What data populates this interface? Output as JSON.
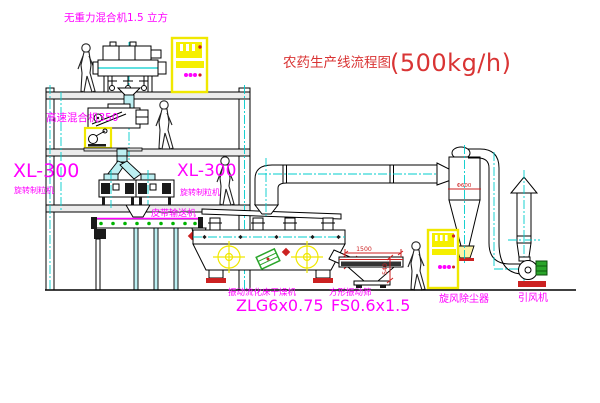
{
  "title": {
    "prefix": "农药生产线流程图",
    "capacity": "(500kg/h)"
  },
  "labels": {
    "gravity_mixer": "无重力混合机1.5 立方",
    "high_speed_mixer": "高速混合机350",
    "granulator_model_left": "XL-300",
    "granulator_name_left": "旋转制粒机",
    "granulator_model_right": "XL-300",
    "granulator_name_right": "旋转制粒机",
    "belt_conveyor": "皮带输送机",
    "dryer_name": "振动流化床干燥机",
    "dryer_model": "ZLG6x0.75",
    "screen_name": "方形振动筛",
    "screen_model": "FS0.6x1.5",
    "cyclone_name": "旋风除尘器",
    "fan_name": "引风机"
  },
  "dims": {
    "screen_length": "1500",
    "screen_total_height": "540",
    "cyclone_diameter": "Φ600"
  },
  "colors": {
    "label_magenta": "#ff00ff",
    "title_red": "#d93434",
    "dimension_red": "#cc2222",
    "centerline_cyan": "#00cccc",
    "cabinet_yellow": "#f0e800",
    "motor_green": "#2aa52a",
    "line_black": "#000000"
  }
}
